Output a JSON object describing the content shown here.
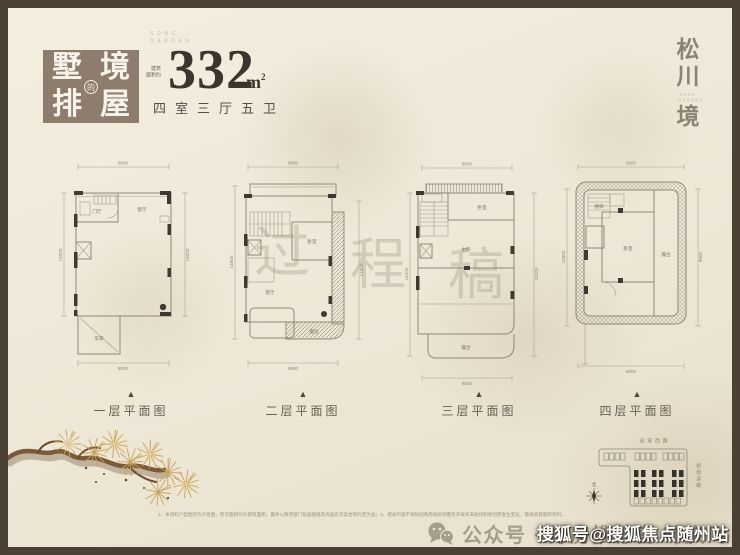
{
  "colors": {
    "frame": "#4a4034",
    "badge_bg": "#8e7d6d",
    "ink": "#3b352d",
    "line": "#8f887a",
    "accent_gold": "#c8a45e"
  },
  "header": {
    "badge": {
      "char_tl": "墅",
      "char_tr": "境",
      "char_bl": "排",
      "char_br": "屋",
      "circle_char": "的"
    },
    "brand_top_1": "SONG",
    "brand_top_2": "GARDEN",
    "area_prefix_1": "建筑",
    "area_prefix_2": "面积约",
    "area_value": "332",
    "area_unit_base": "m",
    "area_unit_sup": "2",
    "rooms_text": "四室三厅五卫",
    "logo_char_1": "松",
    "logo_char_2": "川",
    "logo_char_3": "境",
    "logo_sub_1": "SONG",
    "logo_sub_2": "GARDEN"
  },
  "icons": {
    "north_triangle": "▲"
  },
  "plans": [
    {
      "label": "一层平面图",
      "dim_top": "8800",
      "dim_bottom": "8800",
      "dim_left": "15000",
      "dim_right": "15000",
      "room_1": "门厅",
      "room_2": "客厅",
      "room_3": "车库"
    },
    {
      "label": "二层平面图",
      "dim_top": "8800",
      "dim_bottom": "8800",
      "dim_left": "14900",
      "dim_right": "14900",
      "room_1": "卧室",
      "room_2": "露台",
      "room_3": "客厅"
    },
    {
      "label": "三层平面图",
      "dim_top": "8800",
      "dim_bottom": "8800",
      "dim_left": "14200",
      "dim_right": "14200",
      "room_1": "卧室",
      "room_2": "主卧",
      "room_3": "露台"
    },
    {
      "label": "四层平面图",
      "dim_top": "8800",
      "dim_bottom": "8800",
      "dim_left": "15000",
      "dim_right": "8800",
      "room_1": "楼梯",
      "room_2": "卧室",
      "room_3": "露台"
    }
  ],
  "draft": {
    "c1": "过",
    "c2": "程",
    "c3": "稿"
  },
  "siteplan": {
    "road_top": "迎宾西路",
    "road_right": "规划道路",
    "compass_label": "北"
  },
  "footer": {
    "disclaimer": "1、本资料户型图仅为示意图，所示面积均为建筑面积，最终以政府部门核准图纸及商品房买卖合同约定为准；2、相关内容不排除因政府规划调整及开发商未能控制原因而发生变化，敬请留意最新资料。",
    "wechat_label": "公众号 · 好房推荐官 叶庆飞",
    "sohu_watermark": "搜狐号@搜狐焦点随州站"
  }
}
